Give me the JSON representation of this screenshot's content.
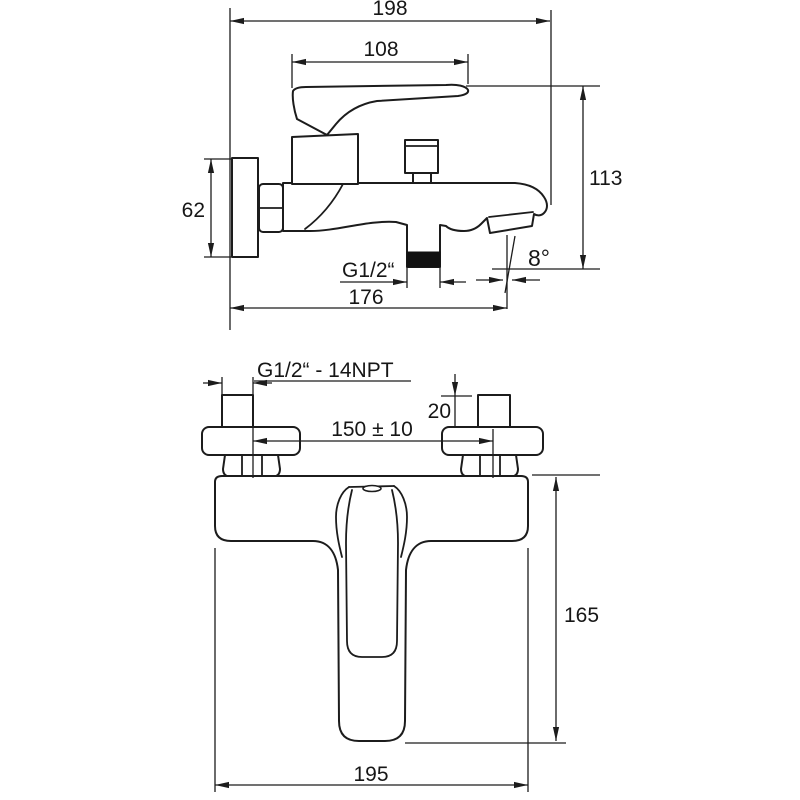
{
  "drawing": {
    "colors": {
      "background": "#ffffff",
      "line": "#1c1c1c"
    },
    "views": {
      "side_view": {
        "dimensions": {
          "total_length": "198",
          "handle_length": "108",
          "total_height": "113",
          "wall_plate_height": "62",
          "length_to_aerator": "176",
          "shower_outlet_thread": "G1/2“",
          "spout_angle": "8°"
        }
      },
      "front_view": {
        "dimensions": {
          "inlet_thread": "G1/2“ - 14NPT",
          "eccentric_projection": "20",
          "inlet_spacing": "150 ± 10",
          "body_height": "165",
          "body_width": "195"
        }
      }
    }
  }
}
